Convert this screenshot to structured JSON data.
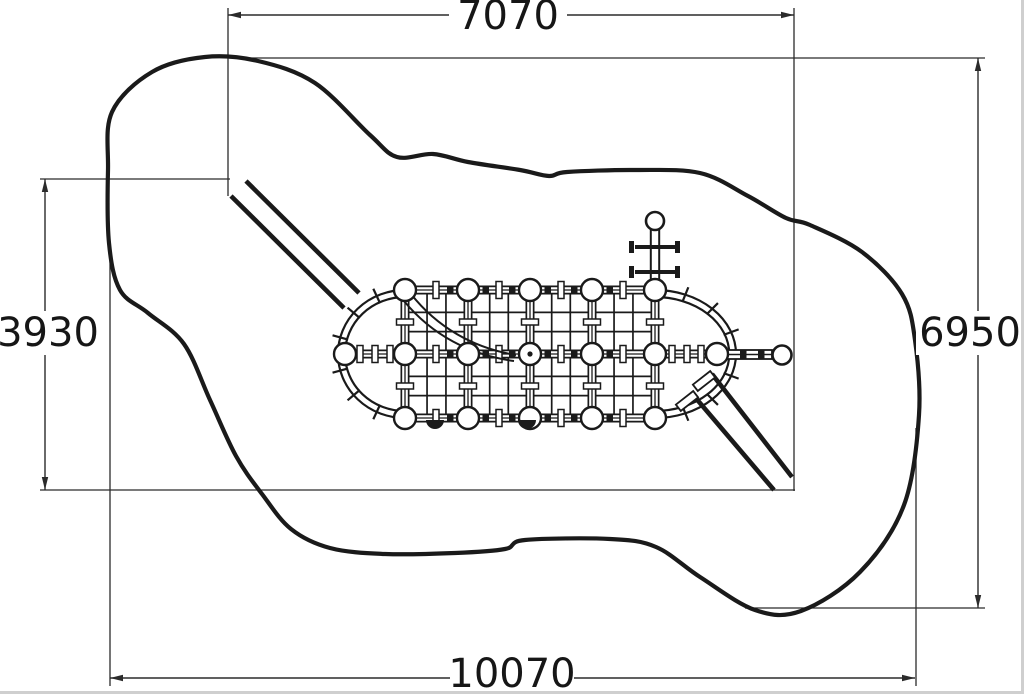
{
  "diagram": {
    "dimensions": {
      "top": "7070",
      "bottom": "10070",
      "left": "3930",
      "right": "6950"
    }
  }
}
